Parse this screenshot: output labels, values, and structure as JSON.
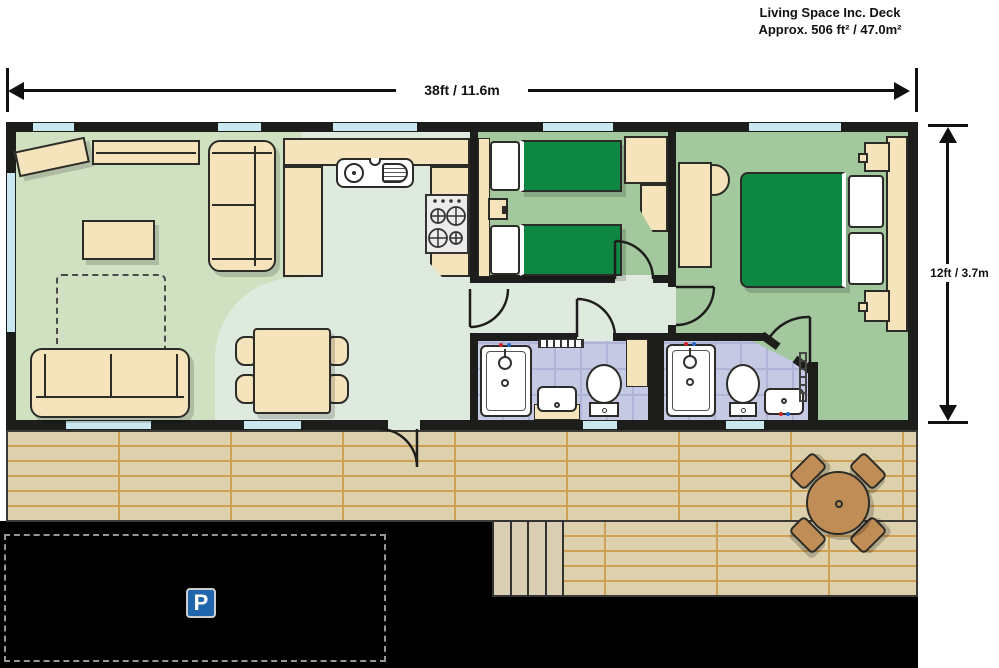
{
  "caption": {
    "line1": "Living Space Inc. Deck",
    "line2": "Approx. 506 ft² / 47.0m²"
  },
  "dimensions": {
    "width": "38ft / 11.6m",
    "height": "12ft / 3.7m"
  },
  "parking": {
    "sign": "P"
  },
  "colors": {
    "wall": "#1d1d1b",
    "win": "#c9e7ee",
    "living": "#cfe1c1",
    "pale": "#dfeade",
    "bed": "#a3c89e",
    "bath": "#c5c9e3",
    "grout": "#afb4d6",
    "beige": "#f4e3bb",
    "outline": "#2b2b28",
    "green": "#0e8742",
    "deck": "#ddd0ac",
    "deckline": "#cfa053",
    "deckedge": "#3c3a35",
    "steps": "#d9cdb4",
    "brown": "#c08d57",
    "drive": "#000000",
    "dash": "#969696",
    "sign": "#2066ad"
  },
  "rooms": [
    {
      "name": "living-room",
      "furniture": [
        "corner-sofa",
        "sofa",
        "coffee-table",
        "sideboard",
        "tv-unit",
        "optional-furniture-outline"
      ]
    },
    {
      "name": "dining-area",
      "furniture": [
        "dining-table",
        "four-chairs"
      ]
    },
    {
      "name": "kitchen",
      "furniture": [
        "sink-with-drainer",
        "hob",
        "worktops"
      ]
    },
    {
      "name": "twin-bedroom",
      "furniture": [
        "single-bed",
        "single-bed",
        "bedside-table",
        "wardrobe"
      ]
    },
    {
      "name": "shower-room",
      "furniture": [
        "shower",
        "washbasin",
        "toilet",
        "radiator"
      ]
    },
    {
      "name": "en-suite-shower-room",
      "furniture": [
        "shower",
        "toilet",
        "washbasin",
        "towel-rail"
      ]
    },
    {
      "name": "double-bedroom",
      "furniture": [
        "double-bed",
        "bedside-tables",
        "lamps",
        "wardrobes",
        "dressing-table",
        "stool"
      ]
    },
    {
      "name": "deck",
      "furniture": [
        "round-patio-table",
        "four-patio-chairs",
        "steps"
      ]
    },
    {
      "name": "driveway",
      "furniture": [
        "parking-bay",
        "parking-sign"
      ]
    }
  ]
}
